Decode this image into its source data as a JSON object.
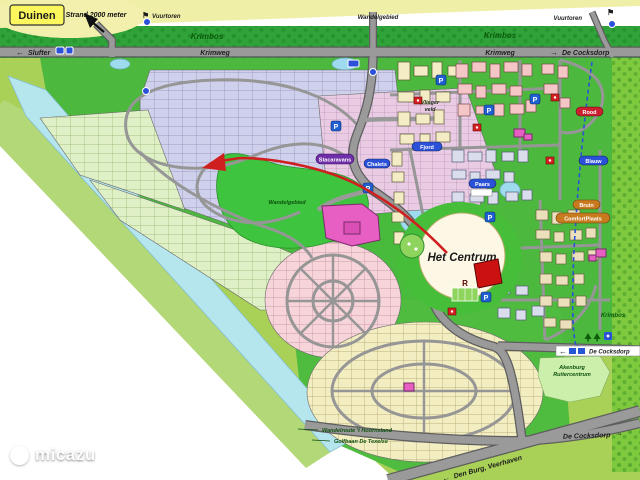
{
  "regions": {
    "duinen": "Duinen",
    "strand": "Strand 2000 meter",
    "vuurtoren_left": "Vuurtoren",
    "vuurtoren_right": "Vuurtoren",
    "krimbos_left": "Krimbos",
    "krimbos_right": "Krimbos",
    "krimbos_small": "Krimbos",
    "wandelgebied_top": "Wandelgebied",
    "wandelgebied_park": "Wandelgebied",
    "vliegerveld_line1": "Vlieger",
    "vliegerveld_line2": "veld",
    "het_centrum": "Het Centrum",
    "stacaravans": "Stacaravans",
    "chalets": "Chalets",
    "fjord": "Fjord",
    "paars": "Paars",
    "rood": "Rood",
    "blauw": "Blauw",
    "bruin": "Bruin",
    "comfortplaats": "ComfortPlaats"
  },
  "roads": {
    "krimweg_left": "Krimweg",
    "krimweg_right": "Krimweg",
    "slufter": "Slufter",
    "de_cocksdorp_top": "De Cocksdorp",
    "de_cocksdorp_sign": "De Cocksdorp",
    "de_cocksdorp_bottom": "De Cocksdorp",
    "den_burg": "Den Burg, Veerhaven",
    "wandelroute": "Wandelroute 't Hoornsland",
    "golfbaan": "Golfbaan De Texelse"
  },
  "poi": {
    "parking": "P",
    "restaurant_marker": "R",
    "ruitercentrum_line1": "Akenburg",
    "ruitercentrum_line2": "Ruitercentrum"
  },
  "glyphs": {
    "arrow_left": "←",
    "arrow_right": "→",
    "arrow_up_left": "↖",
    "flag": "⚑"
  },
  "watermark": {
    "brand": "micazu"
  },
  "colors": {
    "dunes": "#EFEFA8",
    "land": "#A9D157",
    "forest": "#2FA339",
    "water": "#B5E6EE",
    "road": "#9A9A9A",
    "plots_lavender": "#CFD0EC",
    "plots_green": "#DFF0C6",
    "plots_pink": "#F7D3DA",
    "plots_cream": "#F3EDC2",
    "stacaravans_area": "#EACBE4",
    "route_red": "#CF1F1F",
    "route_blue": "#2B51D8",
    "tag_purple": "#6E2FA8",
    "tag_blue": "#2B51D8",
    "tag_red": "#CC2030",
    "tag_orange": "#C87A1E",
    "facility_magenta": "#E75FC3"
  }
}
